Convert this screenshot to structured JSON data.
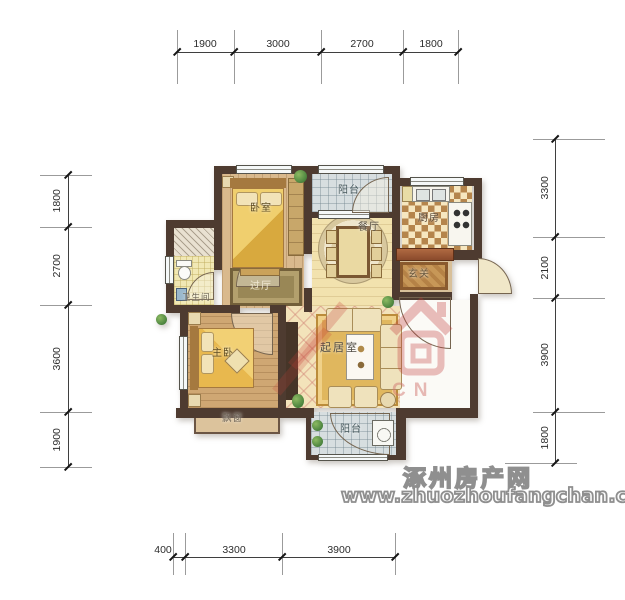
{
  "dimensions": {
    "top": [
      "1900",
      "3000",
      "2700",
      "1800"
    ],
    "left": [
      "1800",
      "2700",
      "3600",
      "1900"
    ],
    "right": [
      "3300",
      "2100",
      "3900",
      "1800"
    ],
    "bottom": [
      "400",
      "3300",
      "3900"
    ]
  },
  "rooms": {
    "bedroom": "卧室",
    "balcony_top": "阳台",
    "dining": "餐厅",
    "kitchen": "厨房",
    "entry": "玄关",
    "bathroom": "卫生间",
    "hall": "过厅",
    "master": "主卧",
    "living": "起居室",
    "bay_window": "飘窗",
    "balcony_bottom": "阳台"
  },
  "watermark": {
    "site_name": "涿州房产网",
    "site_url": "www.zhuozhoufangchan.com",
    "logo_letters": "CN"
  },
  "colors": {
    "wall": "#4e3b30",
    "dim_line": "#3f3f3f",
    "watermark_red": "#c23b3b",
    "watermark_gray": "#8f8f8f"
  }
}
